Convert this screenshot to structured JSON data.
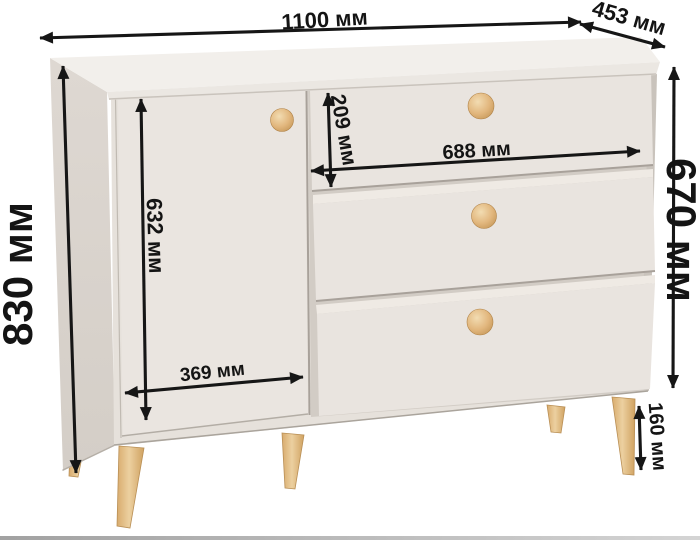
{
  "unit": "мм",
  "dimensions": {
    "overall_width": {
      "label": "1100 мм",
      "value": 1100
    },
    "depth": {
      "label": "453 мм",
      "value": 453
    },
    "overall_height": {
      "label": "830 мм",
      "value": 830
    },
    "body_height": {
      "label": "670 мм",
      "value": 670
    },
    "door_height": {
      "label": "632 мм",
      "value": 632
    },
    "door_width": {
      "label": "369 мм",
      "value": 369
    },
    "top_drawer_height": {
      "label": "209 мм",
      "value": 209
    },
    "drawer_width": {
      "label": "688 мм",
      "value": 688
    },
    "leg_height": {
      "label": "160 мм",
      "value": 160
    }
  },
  "colors": {
    "arrow": "#161616",
    "top_face": "#f2efeb",
    "top_edge_band": "#ebe7e2",
    "left_side": "#d9d3cd",
    "front_face": "#e6e1db",
    "door": "#eae5e0",
    "drawer_front": "#e9e4df",
    "recess": "#d2ccc5",
    "knob_wood": "#e2b77e",
    "leg_wood": "#e5c38c"
  }
}
